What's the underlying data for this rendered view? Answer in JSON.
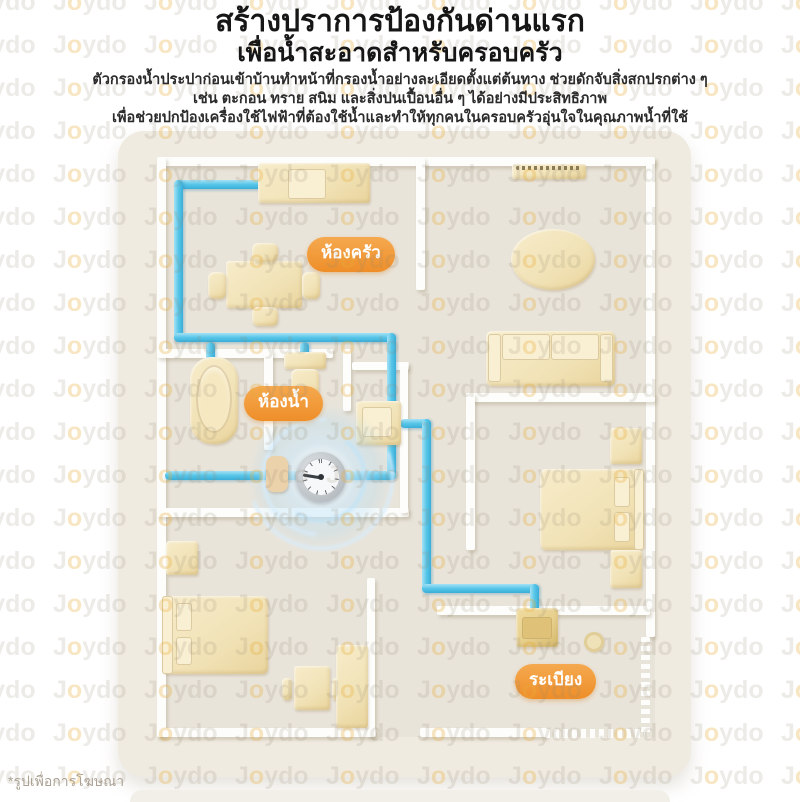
{
  "header": {
    "title": "สร้างปราการป้องกันด่านแรก",
    "subtitle": "เพื่อน้ำสะอาดสำหรับครอบครัว",
    "description_lines": [
      "ตัวกรองน้ำประปาก่อนเข้าบ้านทำหน้าที่กรองน้ำอย่างละเอียดตั้งแต่ต้นทาง ช่วยดักจับสิ่งสกปรกต่าง ๆ",
      "เช่น ตะกอน ทราย สนิม และสิ่งปนเปื้อนอื่น ๆ ได้อย่างมีประสิทธิภาพ",
      "เพื่อช่วยปกป้องเครื่องใช้ไฟฟ้าที่ต้องใช้น้ำและทำให้ทุกคนในครอบครัวอุ่นใจในคุณภาพน้ำที่ใช้"
    ]
  },
  "floor_plan": {
    "room_labels": [
      {
        "id": "kitchen",
        "label": "ห้องครัว"
      },
      {
        "id": "bathroom",
        "label": "ห้องน้ำ"
      },
      {
        "id": "balcony",
        "label": "ระเบียง"
      }
    ]
  },
  "watermark": {
    "text": "Joydo"
  },
  "footnote": "*รูปเพื่อการโฆษณา",
  "colors": {
    "accent_orange": "#EF9334",
    "pipe_blue": "#57C5E8",
    "furniture_yellow": "#F3E6C0",
    "card_beige": "#F0EBE1",
    "wall_white": "#FDFDFB",
    "glow_blue": "#A8D8F4"
  }
}
